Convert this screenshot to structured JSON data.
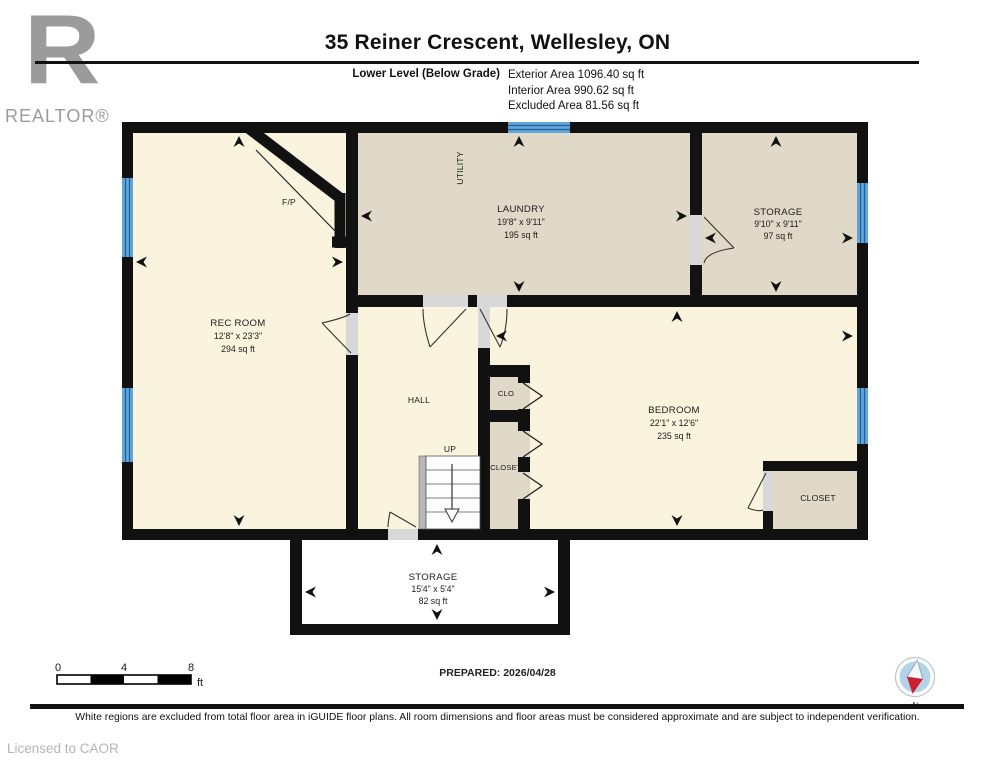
{
  "header": {
    "logo_letter": "R",
    "logo_brand": "REALTOR®",
    "title": "35 Reiner Crescent, Wellesley, ON",
    "level_label": "Lower Level (Below Grade)",
    "areas": [
      "Exterior Area 1096.40 sq ft",
      "Interior Area 990.62 sq ft",
      "Excluded Area 81.56 sq ft"
    ]
  },
  "rooms": [
    {
      "name": "REC ROOM",
      "dims": "12'8\" x 23'3\"",
      "area": "294 sq ft"
    },
    {
      "name": "LAUNDRY",
      "dims": "19'8\" x 9'11\"",
      "area": "195 sq ft"
    },
    {
      "name": "STORAGE",
      "dims": "9'10\" x 9'11\"",
      "area": "97 sq ft"
    },
    {
      "name": "BEDROOM",
      "dims": "22'1\" x 12'6\"",
      "area": "235 sq ft"
    },
    {
      "name": "STORAGE",
      "dims": "15'4\" x 5'4\"",
      "area": "82 sq ft"
    }
  ],
  "labels": {
    "utility": "UTILITY",
    "fireplace": "F/P",
    "hall": "HALL",
    "up": "UP",
    "clo": "CLO",
    "closet_mid": "CLOSET",
    "closet_br": "CLOSET"
  },
  "footer": {
    "scale": {
      "ticks": [
        "0",
        "4",
        "8"
      ],
      "unit": "ft"
    },
    "prepared": "PREPARED: 2026/04/28",
    "compass_label": "N",
    "disclaimer": "White regions are excluded from total floor area in iGUIDE floor plans. All room dimensions and floor areas must be considered approximate and are subject to independent verification.",
    "license": "Licensed to CAOR"
  },
  "colors": {
    "wall": "#111111",
    "interior_cream": "#faf3de",
    "interior_tan": "#e0d9c8",
    "excluded_white": "#ffffff",
    "window_blue": "#62a5d8",
    "compass_red": "#cf1f2f",
    "logo_gray": "#9b9b9b"
  }
}
